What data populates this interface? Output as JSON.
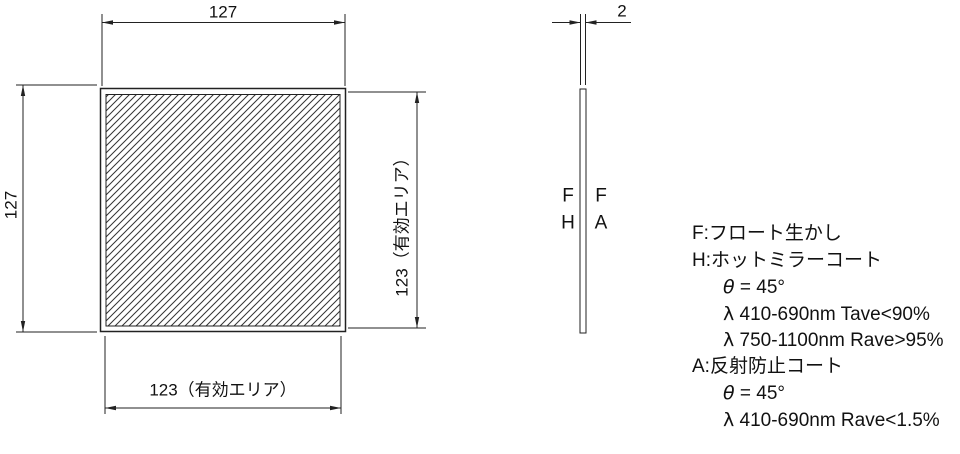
{
  "drawing": {
    "front_view": {
      "width_dim": "127",
      "height_dim": "127",
      "effective_width_dim": "123（有効エリア）",
      "effective_height_dim": "123（有効エリア）"
    },
    "side_view": {
      "thickness_dim": "2",
      "surface_labels": {
        "left_top": "F",
        "left_bottom": "H",
        "right_top": "F",
        "right_bottom": "A"
      }
    },
    "notes": [
      {
        "text": "F:フロート生かし"
      },
      {
        "text": "H:ホットミラーコート"
      },
      {
        "greek": "θ",
        "rest": " = 45°"
      },
      {
        "greek": "λ",
        "rest": " 410-690nm Tave<90%"
      },
      {
        "greek": "λ",
        "rest": " 750-1100nm Rave>95%"
      },
      {
        "text": "A:反射防止コート"
      },
      {
        "greek": "θ",
        "rest": " = 45°"
      },
      {
        "greek": "λ",
        "rest": " 410-690nm Rave<1.5%"
      }
    ],
    "colors": {
      "line": "#222222",
      "hatch": "#333333",
      "text": "#111111",
      "background": "#ffffff"
    }
  }
}
